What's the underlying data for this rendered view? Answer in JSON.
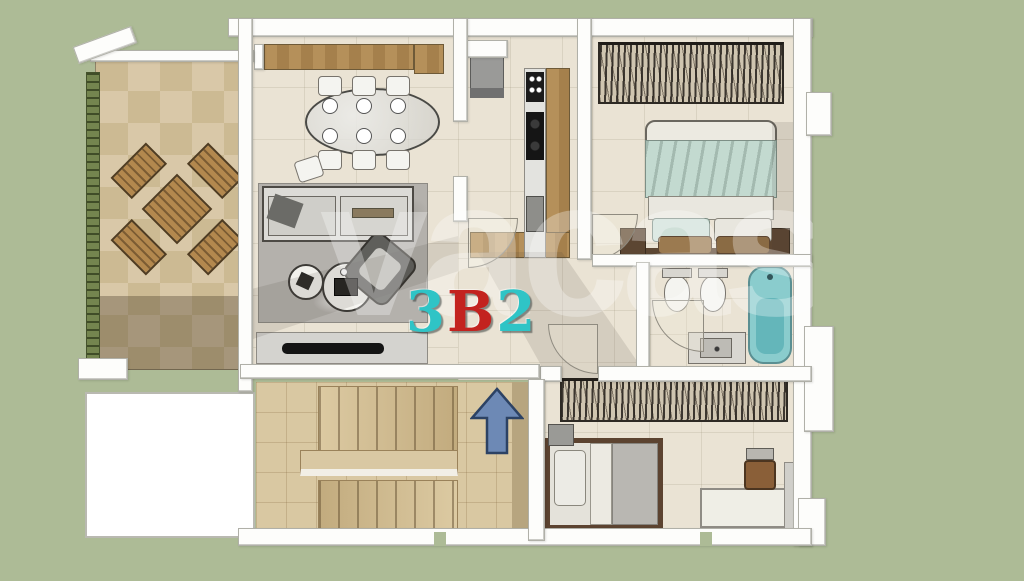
{
  "scene": {
    "description": "3D rendered apartment floor plan, top-down view",
    "unit_label": {
      "full": "3B2",
      "chars": [
        {
          "text": "3",
          "color": "#2fc4c6"
        },
        {
          "text": "B",
          "color": "#c3231f"
        },
        {
          "text": "2",
          "color": "#2fc4c6"
        }
      ]
    },
    "watermark": {
      "text": "vacasa",
      "style": "large translucent white lowercase"
    },
    "entrance_arrow": {
      "direction": "up",
      "fill": "#6d89b5",
      "outline": "#2c4264"
    }
  },
  "palette": {
    "background_green": "#adbb96",
    "wall_white": "#fdfdfb",
    "interior_floor_tile": "#eae3d4",
    "terrace_tile_light": "#d9c8a8",
    "terrace_tile_dark": "#ccba93",
    "hedge_green": "#74854f",
    "wood_cabinet": "#b5905a",
    "stair_tile": "#d9c8a2",
    "bathtub_teal": "#8acccd",
    "bed_linen_teal": "#c3dad0",
    "sofa_gray": "#d8d7d3",
    "wardrobe_clothes_dark": "#2e2a24",
    "tv_black": "#141414"
  }
}
